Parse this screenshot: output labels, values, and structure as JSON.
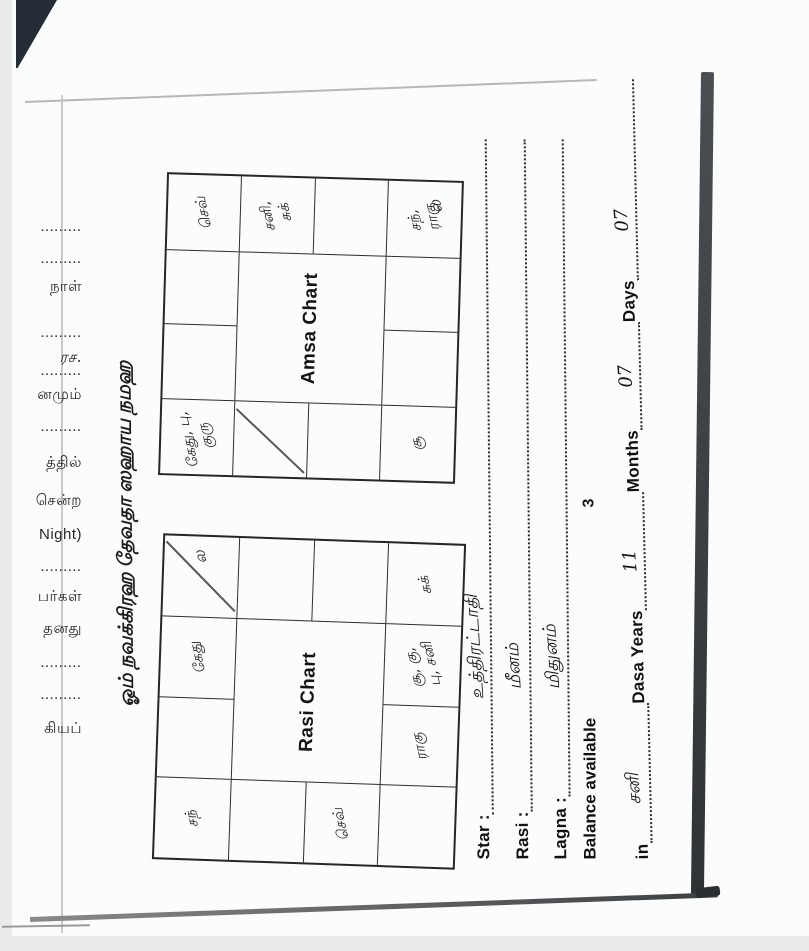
{
  "scan": {
    "page_number": "3",
    "title": "ஓம் நவக்கிரஹ தேவதா ஸஹாய நமஹ",
    "fragments": [
      ".........",
      ".........",
      "நாள்",
      ".........",
      "ரச.",
      ".........",
      "னமும்",
      ".........",
      "த்தில்",
      "சென்ற",
      "Night)",
      ".........",
      "பர்கள்",
      "தனது",
      ".........",
      ".........",
      "கியப்"
    ]
  },
  "rasi_chart": {
    "title": "Rasi Chart",
    "lagna_mark": "ல",
    "pisces": "சந்",
    "taurus": "கேது",
    "capricorn": "செவ்",
    "scorpio": "ராகு",
    "libra_line1": "சூ, கு,",
    "libra_line2": "பு, சனி",
    "virgo": "சுக்"
  },
  "amsa_chart": {
    "title": "Amsa Chart",
    "lagna_mark": "ல",
    "r1c1_line1": "கேது, பு,",
    "r1c1_line2": "குரு",
    "r1c4": "செவ்",
    "r2c4_line1": "சனி,",
    "r2c4_line2": "சுக்",
    "r4c1": "சூ",
    "r4c4_line1": "சந்,",
    "r4c4_line2": "ராகு"
  },
  "form": {
    "star_label": "Star  :",
    "star_value": "உத்திரட்டாதி",
    "rasi_label": "Rasi  :",
    "rasi_value": "மீனம்",
    "lagna_label": "Lagna :",
    "lagna_value": "மிதுனம்",
    "balance_label": "Balance available",
    "in_label": "in",
    "in_value": "சனி",
    "dasa_label": "Dasa Years",
    "dasa_value": "11",
    "months_label": "Months",
    "months_value": "07",
    "days_label": "Days",
    "days_value": "07"
  }
}
